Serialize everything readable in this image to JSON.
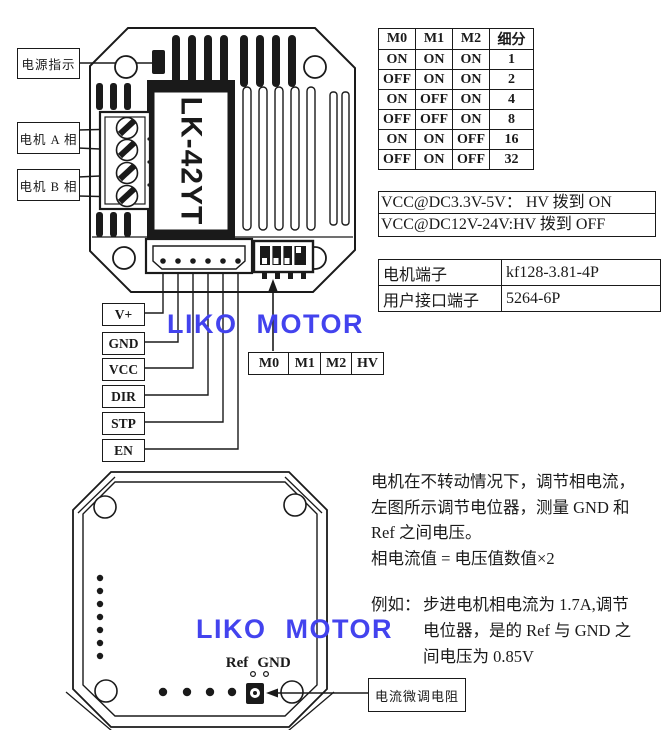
{
  "palette": {
    "ink": "#1a1a1a",
    "watermark_blue": "#4343ee",
    "background": "#ffffff"
  },
  "watermark_text": "LIKO MOTOR",
  "top_device": {
    "model": "LK-42YT",
    "callouts": {
      "power_led": "电源指示",
      "motor_phase_a": "电机 A 相",
      "motor_phase_b": "电机 B 相"
    },
    "pin_labels": [
      "V+",
      "GND",
      "VCC",
      "DIR",
      "STP",
      "EN"
    ],
    "dip_switch_labels": [
      "M0",
      "M1",
      "M2",
      "HV"
    ]
  },
  "microstep_table": {
    "headers": [
      "M0",
      "M1",
      "M2",
      "细分"
    ],
    "rows": [
      [
        "ON",
        "ON",
        "ON",
        "1"
      ],
      [
        "OFF",
        "ON",
        "ON",
        "2"
      ],
      [
        "ON",
        "OFF",
        "ON",
        "4"
      ],
      [
        "OFF",
        "OFF",
        "ON",
        "8"
      ],
      [
        "ON",
        "ON",
        "OFF",
        "16"
      ],
      [
        "OFF",
        "ON",
        "OFF",
        "32"
      ]
    ]
  },
  "voltage_notes": [
    "VCC@DC3.3V-5V： HV 拨到 ON",
    "VCC@DC12V-24V:HV 拨到 OFF"
  ],
  "connector_table": {
    "rows": [
      {
        "name": "电机端子",
        "value": "kf128-3.81-4P"
      },
      {
        "name": "用户接口端子",
        "value": "5264-6P"
      }
    ]
  },
  "bottom_device": {
    "ref_label": "Ref",
    "gnd_label": "GND",
    "pot_callout": "电流微调电阻"
  },
  "instructions": {
    "lines": [
      "电机在不转动情况下，调节相电流，",
      "左图所示调节电位器，测量 GND 和",
      "Ref 之间电压。",
      "相电流值 = 电压值数值×2"
    ],
    "example_prefix": "例如：",
    "example_lines": [
      "步进电机相电流为 1.7A,调节",
      "电位器，是的 Ref 与 GND 之",
      "间电压为 0.85V"
    ]
  }
}
